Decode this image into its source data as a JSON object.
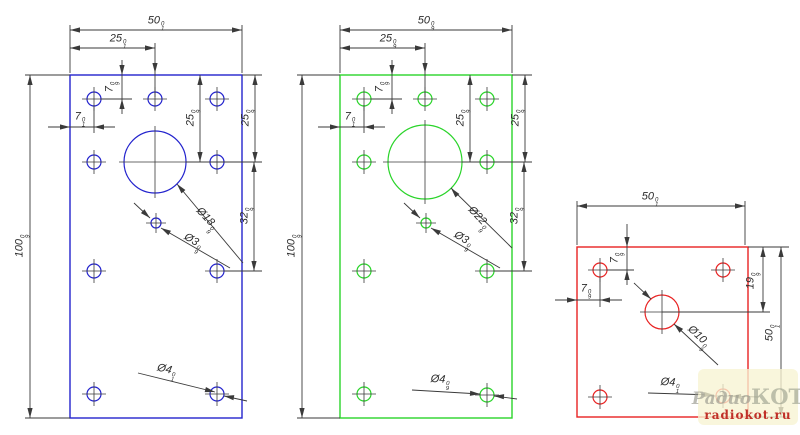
{
  "watermark": {
    "brand_script": "Радио",
    "brand_caps": "КОТ",
    "site": "radiokot.ru"
  },
  "drawing": {
    "ink": "#3a3a3a",
    "plates": [
      {
        "name": "left-blue",
        "color": "#2323cd",
        "rect": [
          70,
          75,
          172,
          343
        ],
        "circles": [
          [
            155,
            162,
            31
          ],
          [
            94,
            99,
            7
          ],
          [
            155,
            99,
            7
          ],
          [
            217,
            99,
            7
          ],
          [
            94,
            162,
            7
          ],
          [
            217,
            162,
            7
          ],
          [
            94,
            271,
            7
          ],
          [
            217,
            271,
            7
          ],
          [
            94,
            394,
            7
          ],
          [
            217,
            394,
            7
          ],
          [
            156,
            223,
            5
          ]
        ]
      },
      {
        "name": "middle-green",
        "color": "#2ad42a",
        "rect": [
          340,
          75,
          172,
          343
        ],
        "circles": [
          [
            425,
            162,
            37
          ],
          [
            364,
            99,
            7
          ],
          [
            425,
            99,
            7
          ],
          [
            487,
            99,
            7
          ],
          [
            364,
            162,
            7
          ],
          [
            487,
            162,
            7
          ],
          [
            364,
            271,
            7
          ],
          [
            487,
            271,
            7
          ],
          [
            364,
            394,
            7
          ],
          [
            487,
            395,
            7
          ],
          [
            426,
            223,
            5
          ]
        ]
      },
      {
        "name": "right-red",
        "color": "#e82222",
        "rect": [
          577,
          247,
          171,
          170
        ],
        "circles": [
          [
            662,
            312,
            17
          ],
          [
            600,
            270,
            7
          ],
          [
            723,
            270,
            7
          ],
          [
            600,
            397,
            7
          ],
          [
            723,
            396,
            7
          ]
        ]
      }
    ],
    "lines": [
      [
        25,
        75,
        70,
        75
      ],
      [
        25,
        418,
        70,
        418
      ],
      [
        30,
        75,
        30,
        418
      ],
      [
        70,
        25,
        70,
        73
      ],
      [
        242,
        25,
        242,
        73
      ],
      [
        70,
        30,
        242,
        30
      ],
      [
        70,
        48,
        155,
        48
      ],
      [
        155,
        43,
        155,
        97
      ],
      [
        122,
        60,
        122,
        114
      ],
      [
        101,
        99,
        132,
        99
      ],
      [
        48,
        127,
        115,
        127
      ],
      [
        94,
        105,
        94,
        133
      ],
      [
        200,
        75,
        200,
        162
      ],
      [
        255,
        75,
        255,
        162
      ],
      [
        242,
        75,
        262,
        75
      ],
      [
        254,
        162,
        254,
        271
      ],
      [
        186,
        162,
        262,
        162
      ],
      [
        224,
        271,
        262,
        271
      ],
      [
        177,
        184,
        243,
        263
      ],
      [
        134,
        203,
        150,
        218
      ],
      [
        161,
        228,
        230,
        268
      ],
      [
        138,
        373,
        215,
        392
      ],
      [
        247,
        401,
        224,
        396
      ],
      [
        297,
        75,
        340,
        75
      ],
      [
        297,
        418,
        340,
        418
      ],
      [
        302,
        75,
        302,
        418
      ],
      [
        340,
        25,
        340,
        73
      ],
      [
        512,
        25,
        512,
        73
      ],
      [
        340,
        30,
        512,
        30
      ],
      [
        340,
        48,
        425,
        48
      ],
      [
        425,
        43,
        425,
        97
      ],
      [
        392,
        60,
        392,
        114
      ],
      [
        371,
        99,
        402,
        99
      ],
      [
        318,
        127,
        385,
        127
      ],
      [
        364,
        105,
        364,
        133
      ],
      [
        470,
        75,
        470,
        162
      ],
      [
        525,
        75,
        525,
        162
      ],
      [
        512,
        75,
        532,
        75
      ],
      [
        524,
        162,
        524,
        271
      ],
      [
        462,
        162,
        532,
        162
      ],
      [
        494,
        271,
        532,
        271
      ],
      [
        451,
        188,
        512,
        248
      ],
      [
        404,
        203,
        420,
        218
      ],
      [
        431,
        228,
        500,
        268
      ],
      [
        412,
        390,
        480,
        394
      ],
      [
        517,
        399,
        494,
        396
      ],
      [
        577,
        201,
        577,
        245
      ],
      [
        745,
        201,
        745,
        245
      ],
      [
        577,
        206,
        745,
        206
      ],
      [
        627,
        224,
        627,
        285
      ],
      [
        607,
        270,
        634,
        270
      ],
      [
        555,
        300,
        622,
        300
      ],
      [
        600,
        277,
        600,
        307
      ],
      [
        748,
        247,
        789,
        247
      ],
      [
        662,
        312,
        770,
        312
      ],
      [
        763,
        247,
        763,
        312
      ],
      [
        781,
        247,
        781,
        417
      ],
      [
        748,
        417,
        789,
        417
      ],
      [
        674,
        324,
        718,
        365
      ],
      [
        634,
        283,
        651,
        299
      ],
      [
        648,
        393,
        714,
        395
      ],
      [
        758,
        397,
        731,
        396
      ]
    ],
    "arrows": [
      [
        30,
        75,
        -90
      ],
      [
        30,
        418,
        90
      ],
      [
        70,
        30,
        180
      ],
      [
        242,
        30,
        0
      ],
      [
        70,
        48,
        180
      ],
      [
        155,
        48,
        0
      ],
      [
        155,
        73,
        90
      ],
      [
        122,
        75,
        90
      ],
      [
        122,
        99,
        -90
      ],
      [
        70,
        127,
        0
      ],
      [
        94,
        127,
        180
      ],
      [
        200,
        75,
        -90
      ],
      [
        200,
        162,
        90
      ],
      [
        255,
        75,
        -90
      ],
      [
        255,
        162,
        90
      ],
      [
        254,
        162,
        -90
      ],
      [
        254,
        271,
        90
      ],
      [
        177,
        184,
        230
      ],
      [
        150,
        218,
        43
      ],
      [
        161,
        228,
        210
      ],
      [
        215,
        392,
        14
      ],
      [
        224,
        396,
        190
      ],
      [
        302,
        75,
        -90
      ],
      [
        302,
        418,
        90
      ],
      [
        340,
        30,
        180
      ],
      [
        512,
        30,
        0
      ],
      [
        340,
        48,
        180
      ],
      [
        425,
        48,
        0
      ],
      [
        425,
        73,
        90
      ],
      [
        392,
        75,
        90
      ],
      [
        392,
        99,
        -90
      ],
      [
        340,
        127,
        0
      ],
      [
        364,
        127,
        180
      ],
      [
        470,
        75,
        -90
      ],
      [
        470,
        162,
        90
      ],
      [
        525,
        75,
        -90
      ],
      [
        525,
        162,
        90
      ],
      [
        524,
        162,
        -90
      ],
      [
        524,
        271,
        90
      ],
      [
        451,
        188,
        230
      ],
      [
        420,
        218,
        43
      ],
      [
        431,
        228,
        210
      ],
      [
        480,
        394,
        4
      ],
      [
        494,
        396,
        184
      ],
      [
        577,
        206,
        180
      ],
      [
        745,
        206,
        0
      ],
      [
        627,
        247,
        90
      ],
      [
        627,
        270,
        -90
      ],
      [
        577,
        300,
        0
      ],
      [
        600,
        300,
        180
      ],
      [
        763,
        247,
        -90
      ],
      [
        763,
        312,
        90
      ],
      [
        781,
        247,
        -90
      ],
      [
        781,
        417,
        90
      ],
      [
        674,
        324,
        223
      ],
      [
        651,
        299,
        43
      ],
      [
        714,
        395,
        3
      ],
      [
        731,
        396,
        183
      ]
    ],
    "labels": [
      {
        "x": 156,
        "y": 23,
        "rot": 0,
        "m": "50",
        "tt": "0",
        "tb": "1"
      },
      {
        "x": 118,
        "y": 41,
        "rot": 0,
        "m": "25",
        "tt": "0",
        "tb": "1"
      },
      {
        "x": 112,
        "y": 87,
        "rot": -90,
        "m": "7",
        "tt": "0",
        "tb": "9"
      },
      {
        "x": 80,
        "y": 119,
        "rot": 0,
        "m": "7",
        "tt": "0",
        "tb": "1"
      },
      {
        "x": 193,
        "y": 118,
        "rot": -90,
        "m": "25",
        "tt": "0",
        "tb": "9"
      },
      {
        "x": 248,
        "y": 118,
        "rot": -90,
        "m": "25",
        "tt": "0",
        "tb": "9"
      },
      {
        "x": 247,
        "y": 216,
        "rot": -90,
        "m": "32",
        "tt": "0",
        "tb": "9"
      },
      {
        "x": 22,
        "y": 246,
        "rot": -90,
        "m": "100",
        "tt": "0",
        "tb": "9"
      },
      {
        "x": 205,
        "y": 220,
        "rot": 47,
        "m": "Ø18",
        "tt": "0",
        "tb": "9"
      },
      {
        "x": 192,
        "y": 243,
        "rot": 30,
        "m": "Ø3",
        "tt": "0",
        "tb": "9"
      },
      {
        "x": 166,
        "y": 372,
        "rot": 13,
        "m": "Ø4",
        "tt": "0",
        "tb": "1"
      },
      {
        "x": 426,
        "y": 23,
        "rot": 0,
        "m": "50",
        "tt": "0",
        "tb": "9"
      },
      {
        "x": 388,
        "y": 41,
        "rot": 0,
        "m": "25",
        "tt": "0",
        "tb": "9"
      },
      {
        "x": 382,
        "y": 87,
        "rot": -90,
        "m": "7",
        "tt": "0",
        "tb": "9"
      },
      {
        "x": 350,
        "y": 119,
        "rot": 0,
        "m": "7",
        "tt": "0",
        "tb": "1"
      },
      {
        "x": 463,
        "y": 118,
        "rot": -90,
        "m": "25",
        "tt": "0",
        "tb": "9"
      },
      {
        "x": 518,
        "y": 118,
        "rot": -90,
        "m": "25",
        "tt": "0",
        "tb": "9"
      },
      {
        "x": 517,
        "y": 216,
        "rot": -90,
        "m": "32",
        "tt": "0",
        "tb": "9"
      },
      {
        "x": 294,
        "y": 246,
        "rot": -90,
        "m": "100",
        "tt": "0",
        "tb": "9"
      },
      {
        "x": 477,
        "y": 219,
        "rot": 47,
        "m": "Ø22",
        "tt": "0",
        "tb": "9"
      },
      {
        "x": 462,
        "y": 241,
        "rot": 30,
        "m": "Ø3",
        "tt": "0",
        "tb": "9"
      },
      {
        "x": 440,
        "y": 382,
        "rot": 4,
        "m": "Ø4",
        "tt": "0",
        "tb": "9"
      },
      {
        "x": 650,
        "y": 199,
        "rot": 0,
        "m": "50",
        "tt": "0",
        "tb": "1"
      },
      {
        "x": 617,
        "y": 258,
        "rot": -90,
        "m": "7",
        "tt": "0",
        "tb": "9"
      },
      {
        "x": 586,
        "y": 291,
        "rot": 0,
        "m": "7",
        "tt": "0",
        "tb": "9"
      },
      {
        "x": 753,
        "y": 281,
        "rot": -90,
        "m": "19",
        "tt": "0",
        "tb": "9"
      },
      {
        "x": 772,
        "y": 333,
        "rot": -90,
        "m": "50",
        "tt": "0",
        "tb": "1"
      },
      {
        "x": 697,
        "y": 338,
        "rot": 43,
        "m": "Ø10",
        "tt": "0",
        "tb": "9"
      },
      {
        "x": 670,
        "y": 385,
        "rot": 4,
        "m": "Ø4",
        "tt": "0",
        "tb": "1"
      }
    ]
  }
}
